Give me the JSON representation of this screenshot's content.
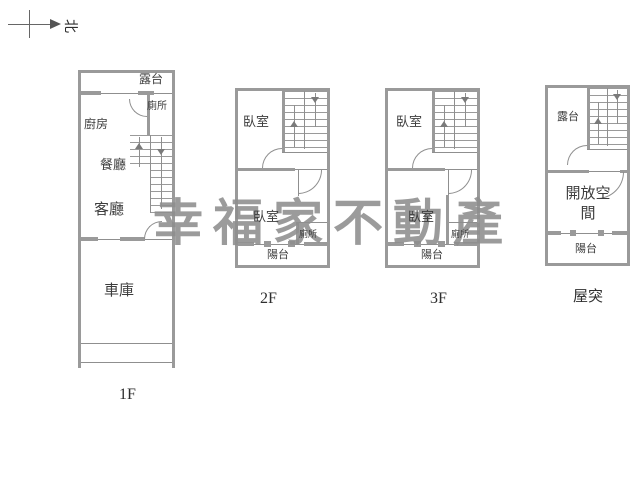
{
  "compass": {
    "north_label": "北"
  },
  "watermark": {
    "text": "幸福家不動產"
  },
  "units": {
    "f1": {
      "floor_label": "1F",
      "rooms": {
        "terrace": "露台",
        "toilet": "廁所",
        "kitchen": "廚房",
        "dining": "餐廳",
        "living": "客廳",
        "garage": "車庫"
      }
    },
    "f2": {
      "floor_label": "2F",
      "rooms": {
        "bedroom_top": "臥室",
        "bedroom_bottom": "臥室",
        "toilet": "廁所",
        "balcony": "陽台"
      }
    },
    "f3": {
      "floor_label": "3F",
      "rooms": {
        "bedroom_top": "臥室",
        "bedroom_bottom": "臥室",
        "toilet": "廁所",
        "balcony": "陽台"
      }
    },
    "roof": {
      "floor_label": "屋突",
      "rooms": {
        "terrace": "露台",
        "open_space": "開放空間",
        "balcony": "陽台"
      }
    }
  },
  "colors": {
    "wall": "#9a9a9a",
    "line": "#8f8f8f",
    "text": "#3d3d3d",
    "watermark": "#8e8e8e"
  }
}
